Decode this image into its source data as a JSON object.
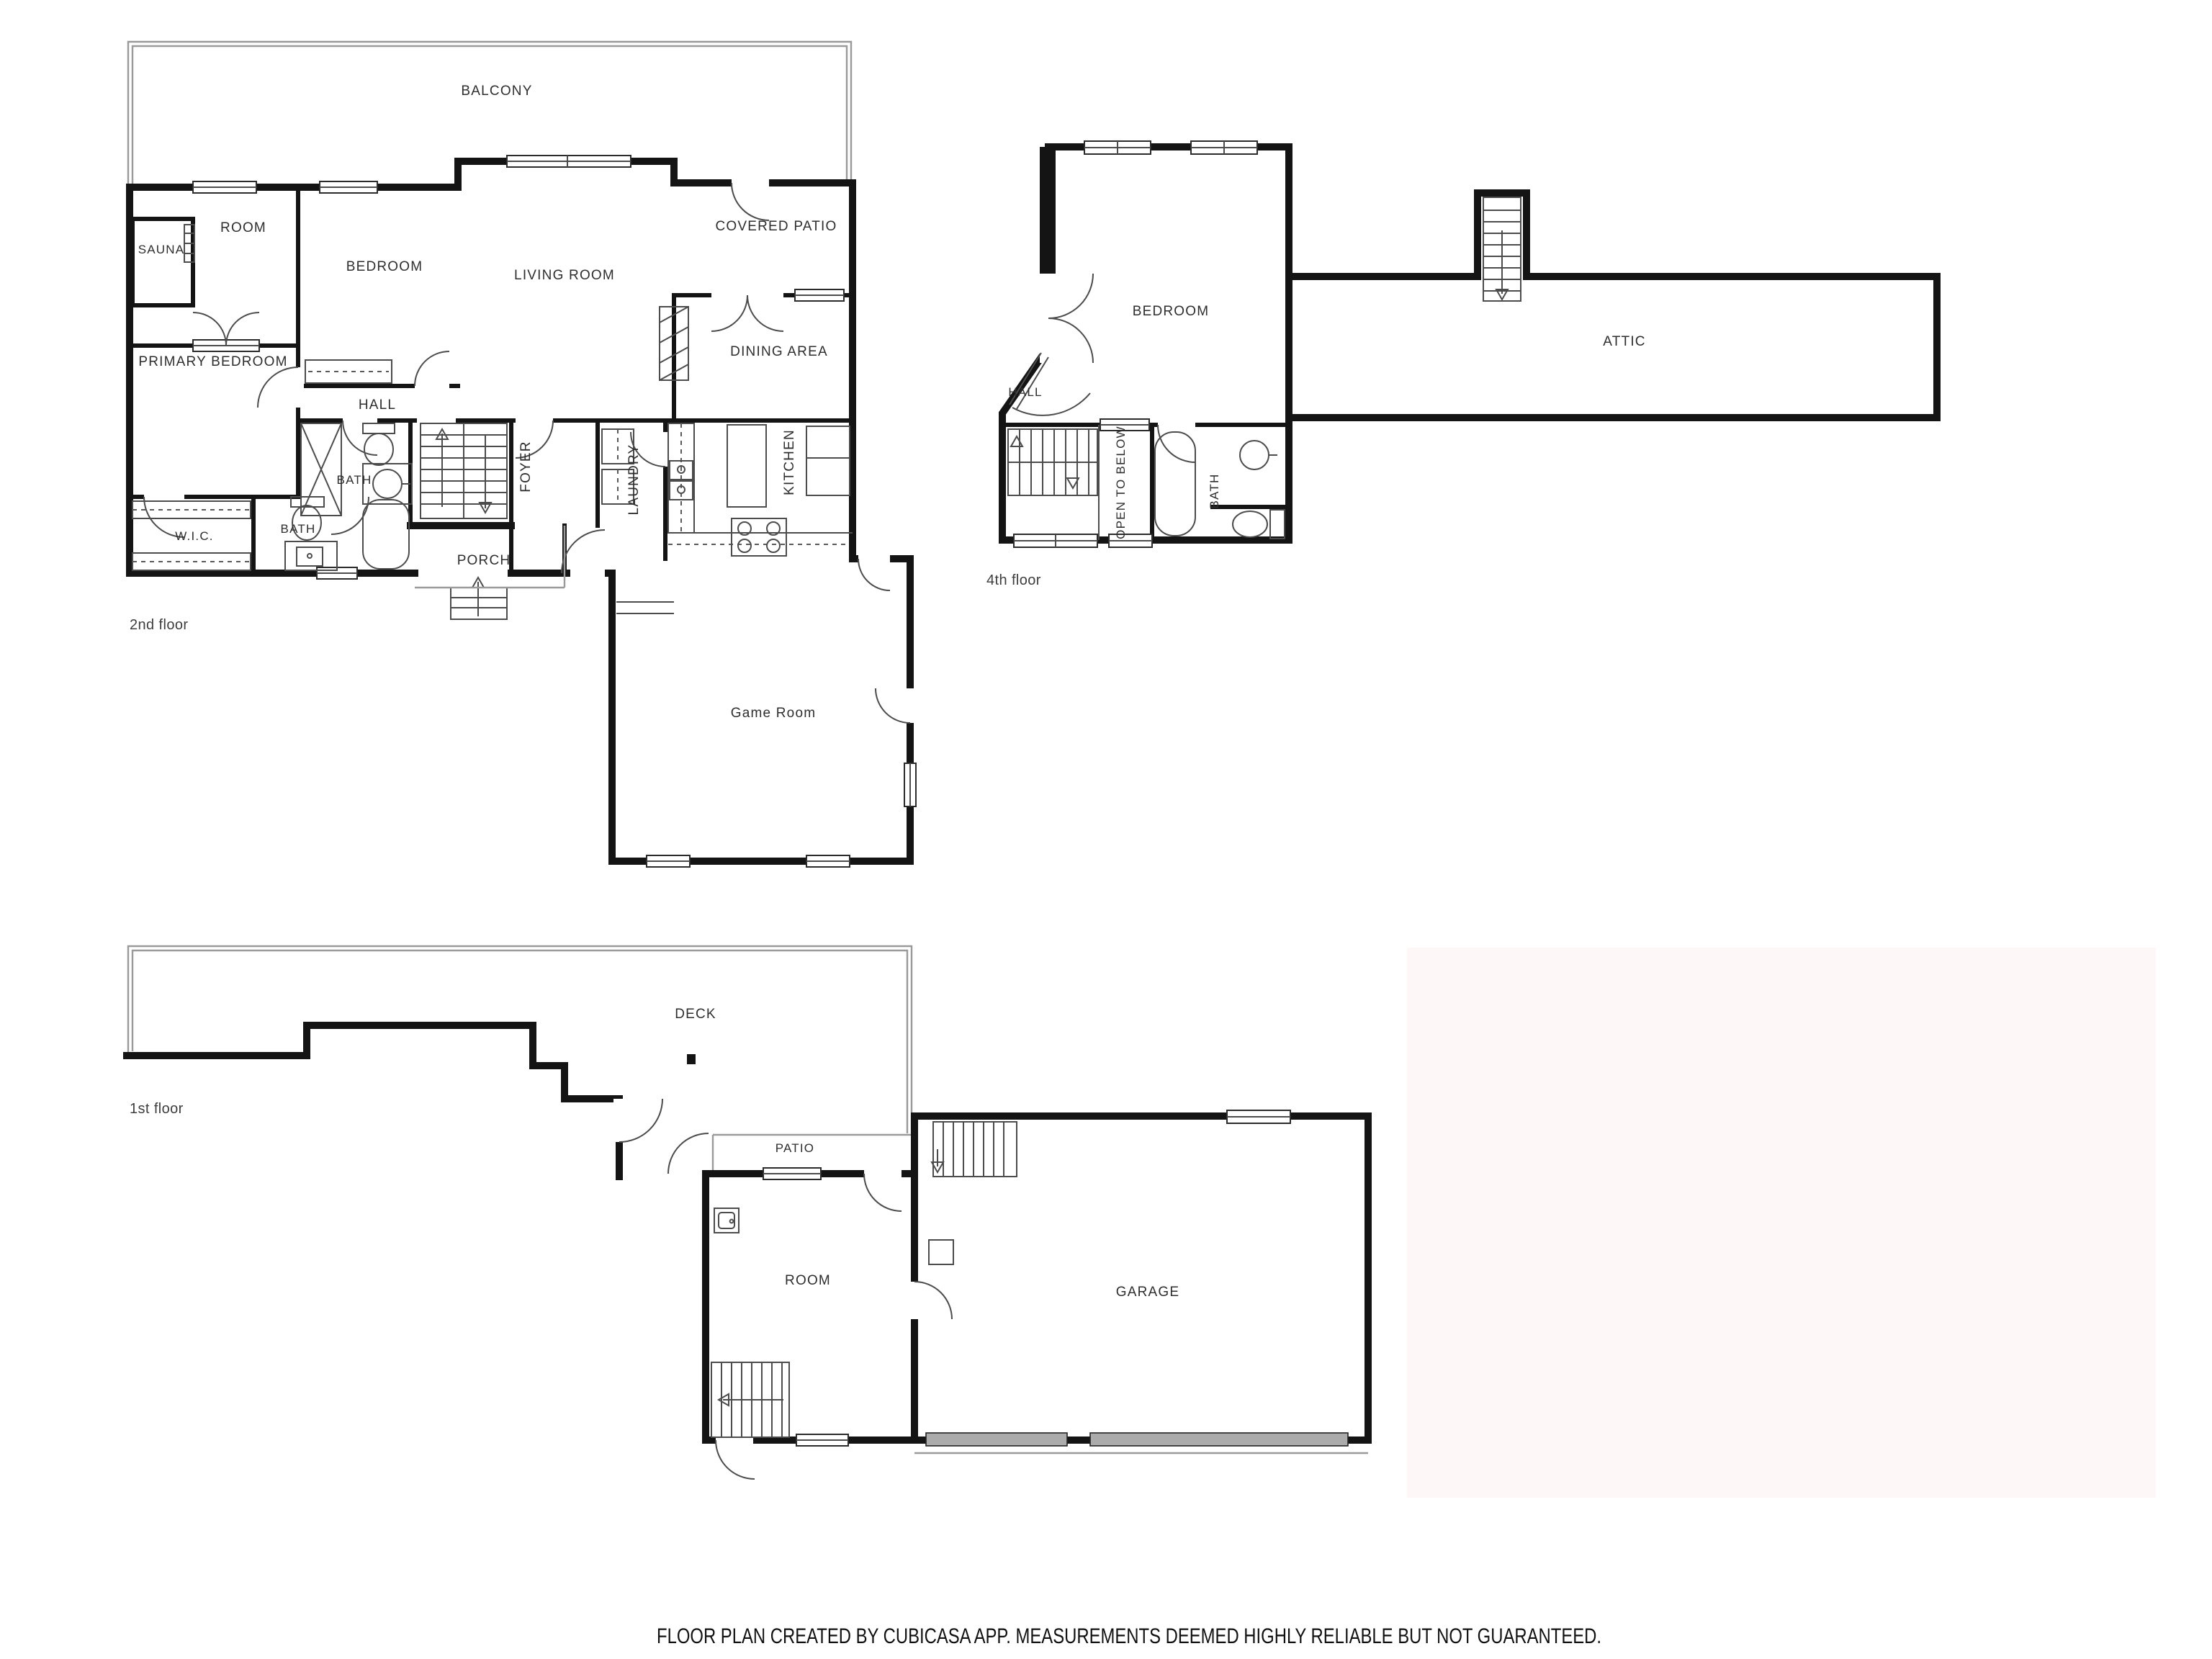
{
  "footer": {
    "text": "FLOOR PLAN CREATED BY CUBICASA APP. MEASUREMENTS DEEMED HIGHLY RELIABLE BUT NOT GUARANTEED."
  },
  "colors": {
    "wall": "#141414",
    "thin_line": "#4c4c4c",
    "light_line": "#9a9a9a",
    "garage_door": "#ababab",
    "watermark": "#fdf7f8",
    "label_text": "#2e2e2e"
  },
  "floors": {
    "second": {
      "label": "2nd floor",
      "rooms": {
        "balcony": "BALCONY",
        "sauna": "SAUNA",
        "room": "ROOM",
        "bedroom": "BEDROOM",
        "living": "LIVING ROOM",
        "covered_patio": "COVERED PATIO",
        "dining": "DINING AREA",
        "primary": "PRIMARY BEDROOM",
        "hall": "HALL",
        "bath_upper": "BATH",
        "foyer": "FOYER",
        "laundry": "LAUNDRY",
        "kitchen": "KITCHEN",
        "wic": "W.I.C.",
        "bath_lower": "BATH",
        "porch": "PORCH",
        "game_room": "Game Room"
      }
    },
    "fourth": {
      "label": "4th floor",
      "rooms": {
        "bedroom": "BEDROOM",
        "hall": "HALL",
        "open_to_below": "OPEN TO BELOW",
        "bath": "BATH",
        "attic": "ATTIC"
      }
    },
    "first": {
      "label": "1st floor",
      "rooms": {
        "deck": "DECK",
        "patio": "PATIO",
        "room": "ROOM",
        "garage": "GARAGE"
      }
    }
  }
}
